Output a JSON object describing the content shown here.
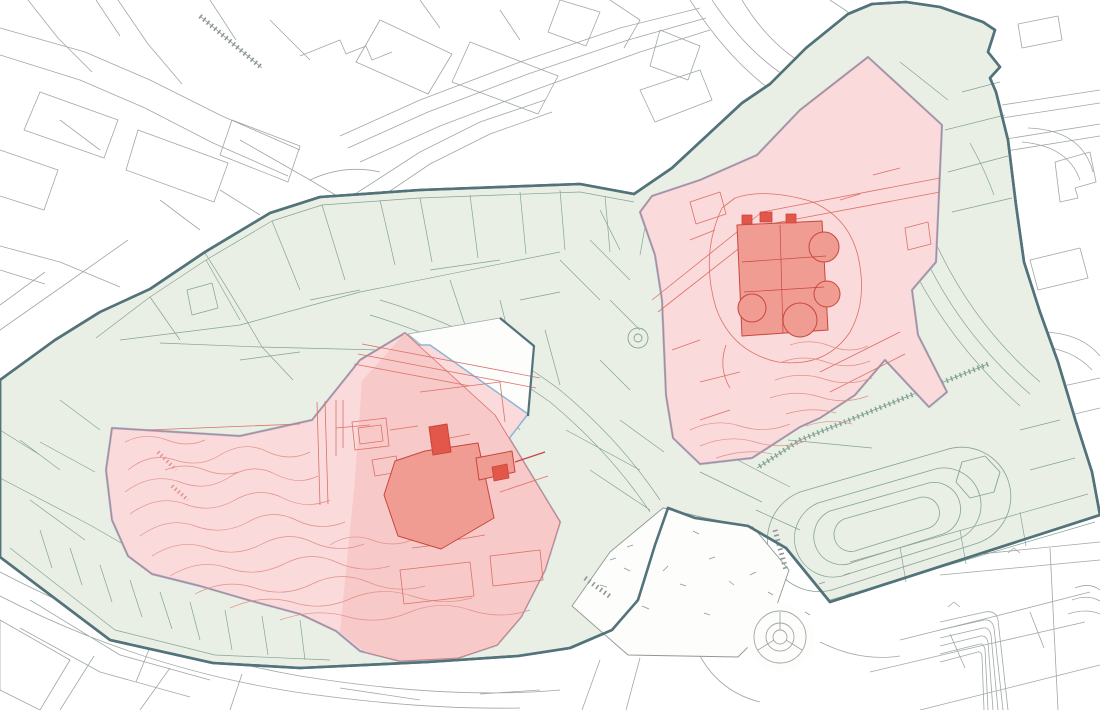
{
  "meta": {
    "title": "",
    "visible_text": []
  },
  "canvas": {
    "width": 1100,
    "height": 710
  },
  "palette": {
    "white": "#fdfdfc",
    "city_line": "#a0a7a7",
    "city_line_dark": "#8f9898",
    "green_fill": "#e9efe5",
    "green_line": "#85a396",
    "boundary": "#53737b",
    "blue_edge": "#8cb6d8",
    "pink_light": "#fadadb",
    "pink_deep": "#f7c9c8",
    "red_line": "#dd7068",
    "contour": "#e29189",
    "building_fill": "#f09c93",
    "building_dark": "#e2574a",
    "building_stroke": "#c8473c",
    "none": "none"
  },
  "layers": [
    {
      "name": "city-street-lines",
      "elements": [
        {
          "t": "path",
          "n": "city-streets-northwest",
          "s": "city_line",
          "w": 0.8,
          "d": "M0 28 L85 52 L150 80 L222 116 L300 150 M0 55 L80 80 L145 108 L213 143 L288 176 M28 0 L58 38 L92 72 M118 0 L148 44 L182 84 M0 150 L58 170 L44 210 L0 196 M40 92 L118 120 L104 158 L24 130 Z M138 130 L228 163 L214 202 L126 170 Z M232 120 L300 146 L288 182 L220 155 Z M0 246 L60 262 M0 270 L45 284 M60 262 L120 287 M0 330 L60 288 L128 240 M0 305 L45 272 M96 0 L120 36 M210 0 L236 40 M270 20 L310 60 M60 120 L100 150 M160 200 L200 230 M220 190 L260 215"
        },
        {
          "t": "path",
          "n": "city-streets-top-center",
          "s": "city_line",
          "w": 0.8,
          "d": "M340 136 L420 100 L520 62 L620 28 L700 8 M348 148 L428 112 L528 74 L628 40 L706 18 M360 162 L440 126 L540 88 L640 52 L710 30 M380 20 L452 54 L428 94 L356 62 Z M470 42 L558 76 L538 114 L452 82 Z M560 0 L600 12 L586 46 L548 32 Z M420 0 L440 28 M500 10 L520 40 M610 0 L640 20 L624 48 M660 30 L700 46 L688 80 L650 66 Z M640 90 L700 70 L712 100 L655 122 Z M300 56 L340 40 L346 54 L366 46 L372 60 L392 52 M240 140 L310 180 L344 200 M310 180 Q344 164 380 172 M330 206 L352 197 L348 215 Z M299 219 L321 211 L317 229 Z M352 196 L420 152 L480 122 L545 100 M362 210 L430 164 L490 134 L552 112"
        },
        {
          "t": "path",
          "n": "city-streets-northeast",
          "s": "city_line",
          "w": 0.8,
          "d": "M690 0 Q726 56 768 88 M712 0 Q744 48 782 74 M742 0 Q766 40 800 62 M1018 24 L1058 16 L1062 40 L1022 48 Z M1002 105 L1100 90 M1002 118 L1100 103 M1000 140 L1100 124 M1000 152 L1100 136 M1028 128 Q1082 130 1093 172 M1022 142 Q1068 146 1080 180 M1055 162 L1090 152 L1096 182 L1075 188 L1078 198 L1060 202 Z M830 0 L848 12 M960 250 L1010 238 L1018 268 L968 280 Z M1030 260 L1080 248 L1088 278 L1038 290 Z M975 302 L1030 290 L1038 320 L983 332 Z M1040 332 Q1080 332 1100 356 M1035 346 Q1072 348 1092 370 M1045 390 L1100 378 M1050 420 L1100 408"
        },
        {
          "t": "path",
          "n": "city-streets-south",
          "s": "city_line",
          "w": 0.8,
          "d": "M900 640 L1000 615 L1090 592 M870 672 L980 646 L1085 622 M920 710 L1020 685 L1100 665 M950 634 L965 668 M1030 612 L1044 648 M940 558 L1100 542 M940 575 L1100 560 M1050 548 L1058 710 M600 660 L582 710 M640 658 L626 710 M700 656 Q720 692 760 702 M820 642 Q860 662 900 656 M0 572 Q150 650 300 676 Q450 700 560 690 M0 596 Q140 668 295 692 Q420 710 520 708 M60 710 L94 656 M140 710 L170 668 M30 600 L120 655 L210 680 M20 628 L100 672 L190 697 M152 642 L136 682 M242 674 L230 710 M0 620 L70 660 L40 710 L0 690 Z M340 688 L420 700 M480 694 L540 690"
        },
        {
          "t": "path",
          "n": "terraced-building-lines",
          "s": "city_line",
          "w": 0.8,
          "d": "M940 622 L985 612 Q996 610 998 620 L1008 710 M940 630 L984 620 Q992 619 994 628 L1003 710 M940 638 L983 628 Q989 627 991 635 L998 710 M940 646 L981 636 Q986 635 988 642 L993 710 M940 654 L980 644 Q983 643 985 649 L988 710 M940 662 L978 652 Q981 651 982 656 L984 710 M1008 553 L1014 548 L1020 553 M948 607 L954 602 L960 607 M1075 588 Q1090 582 1100 590 M1072 600 Q1088 594 1100 601 M1068 614 Q1086 608 1100 614"
        },
        {
          "t": "path",
          "n": "railway-hatch-line",
          "s": "city_line_dark",
          "w": 5,
          "dash": "1.6 3.2",
          "d": "M200 16 L262 68"
        },
        {
          "t": "path",
          "n": "railway-line",
          "s": "city_line_dark",
          "w": 0.8,
          "d": "M200 16 L262 68"
        }
      ]
    },
    {
      "name": "protected-zone",
      "elements": [
        {
          "t": "polygon",
          "n": "protected-zone-area",
          "f": "green_fill",
          "s": "boundary",
          "w": 2.6,
          "pts": "0,380 55,340 100,312 150,289 205,252 270,213 320,197 420,190 580,184 634,194 672,168 742,103 770,84 806,48 848,14 872,4 906,2 940,7 983,22 995,30 988,52 1000,67 990,78 996,92 1008,140 1016,205 1024,262 1040,312 1058,362 1076,422 1092,472 1100,515 830,602 786,548 748,526 695,518 668,508 655,545 638,600 612,630 570,648 518,656 428,662 300,668 213,663 110,640 0,557"
        }
      ]
    },
    {
      "name": "cadastral-parcel-lines",
      "elements": [
        {
          "t": "path",
          "n": "parcel-lines-northwest",
          "s": "green_line",
          "w": 0.7,
          "d": "M96 338 L150 297 L206 260 L272 221 L322 205 L420 198 L580 192 L634 202 M150 297 L180 340 M206 260 L240 320 M272 221 L300 290 M322 205 L345 280 M380 200 L395 265 M420 198 L432 262 M470 195 L478 258 M520 192 L526 254 M560 190 L565 250 M605 196 L610 252 M120 340 L240 325 L360 292 L560 252 M205 253 Q235 300 262 347 L293 380 M160 343 L260 347 L380 350 M187 290 L212 283 L218 308 L192 315 Z M240 360 L300 352 M310 300 L360 290 M430 270 L500 260 M520 300 L560 292"
        },
        {
          "t": "path",
          "n": "parcel-lines-old-town",
          "s": "green_line",
          "w": 0.7,
          "d": "M380 300 Q480 330 560 390 Q620 440 660 500 M370 315 Q470 345 550 402 Q610 452 650 512 M450 280 L470 340 M500 300 L515 360 M545 330 L560 385 M480 380 L520 430 M430 360 L460 420 M400 380 L428 438 M560 260 L600 300 M590 240 L630 280 M610 300 L640 330 M600 360 L630 390 M566 430 L640 470 M590 470 L650 510 M620 420 L664 452 M648 210 L640 255 M600 210 L620 250"
        },
        {
          "t": "path",
          "n": "parcel-lines-east",
          "s": "green_line",
          "w": 0.7,
          "d": "M945 130 L1005 115 M948 172 L1008 156 M952 212 L1012 198 M962 92 L1000 82 M880 92 L930 130 M900 62 L948 100 M930 230 Q968 320 1040 382 M918 242 Q956 330 1030 394 M906 254 Q946 340 1020 406 M970 143 Q985 170 994 195 M1020 430 L1060 420 M1030 470 L1075 458"
        },
        {
          "t": "path",
          "n": "parcel-lines-south",
          "s": "green_line",
          "w": 0.7,
          "d": "M10 548 L115 630 L215 655 L330 660 M40 530 L52 568 M70 548 L82 585 M100 565 L112 602 M130 580 L142 617 M160 592 L172 629 M190 602 L200 640 M225 610 L232 650 M262 616 L268 655 M300 620 L305 660 M0 478 L90 525 L130 548 M20 440 L60 470 M60 400 L100 430 M40 442 L95 472 M30 500 L85 540 M0 430 L40 455 M830 600 L1095 522 M850 562 L1088 494 M900 547 L906 582 M960 530 L966 564 M1020 512 L1026 546 M700 472 L762 502 M722 452 L790 487 M756 510 L800 530"
        },
        {
          "t": "path",
          "n": "stadium-track",
          "s": "green_line",
          "w": 0.8,
          "d": "M800 492 L945 450 A48 48 0 0 1 978 543 L838 588 A48 48 0 0 1 800 492 Z M818 503 L932 470 A36 36 0 0 1 956 540 L848 574 A36 36 0 0 1 818 503 Z M830 511 L925 484 A26 26 0 0 1 943 534 L854 562 A26 26 0 0 1 830 511 Z M844 519 L918 498 A15 15 0 0 1 929 528 L858 550 A15 15 0 0 1 844 519 Z M788 440 L872 448"
        },
        {
          "t": "path",
          "n": "hexagon-building",
          "s": "green_line",
          "w": 0.9,
          "d": "M962 462 L985 456 L1000 472 L994 492 L970 498 L956 482 Z"
        },
        {
          "t": "circle",
          "n": "well-circle-outer",
          "s": "green_line",
          "w": 0.9,
          "cx": 638,
          "cy": 338,
          "r": 10
        },
        {
          "t": "circle",
          "n": "well-circle-inner",
          "s": "green_line",
          "w": 0.9,
          "cx": 638,
          "cy": 338,
          "r": 4
        },
        {
          "t": "path",
          "n": "retaining-wall-hatch",
          "s": "green_line",
          "w": 5,
          "dash": "1.6 3.2",
          "d": "M988 364 L800 440 L757 468"
        },
        {
          "t": "path",
          "n": "retaining-wall-line",
          "s": "green_line",
          "w": 0.8,
          "d": "M988 364 L800 440 L757 468"
        }
      ]
    },
    {
      "name": "street-wedge",
      "elements": [
        {
          "t": "polygon",
          "n": "access-road-wedge",
          "f": "white",
          "s": "city_line",
          "w": 0.8,
          "pts": "500,318 534,346 528,416 430,352 408,334"
        }
      ]
    },
    {
      "name": "monument-zone-castle-hill",
      "elements": [
        {
          "t": "polygon",
          "n": "castle-hill-zone-area",
          "f": "pink_light",
          "s": "blue_edge",
          "w": 2.2,
          "pts": "112,428 160,431 240,436 312,420 360,360 405,333 495,415 560,522 545,570 521,617 497,645 458,658 400,661 360,651 336,631 300,614 248,600 200,586 152,574 128,556 112,520 106,470"
        },
        {
          "t": "polygon",
          "n": "castle-hill-northeast-lobe",
          "f": "pink_light",
          "s": "blue_edge",
          "w": 1.5,
          "pts": "430,345 528,414 508,440 452,396 412,345"
        },
        {
          "t": "polygon",
          "n": "castle-esplanade-area",
          "f": "pink_deep",
          "pts": "405,333 495,415 560,522 545,570 521,617 497,645 458,658 400,661 365,652 340,632 355,480 362,381"
        },
        {
          "t": "polygon",
          "n": "castle-hill-red-boundary",
          "s": "red_line",
          "w": 0.8,
          "pts": "112,428 160,431 240,436 312,420 360,360 405,333 495,415 560,522 545,570 521,617 497,645 458,658 400,661 360,651 336,631 300,614 248,600 200,586 152,574 128,556 112,520 106,470"
        },
        {
          "t": "path",
          "n": "hill-contour-lines",
          "s": "contour",
          "w": 0.7,
          "d": "M125 442 Q145 432 167 440 Q187 448 205 440 M128 470 Q150 452 175 460 Q200 468 220 455 Q245 440 268 452 Q290 462 310 452 M125 492 Q152 472 180 482 Q205 492 228 478 Q252 462 275 474 Q298 486 318 476 M130 514 Q158 494 185 504 Q210 514 235 500 Q260 486 283 498 Q306 510 330 500 M140 536 Q168 516 195 526 Q222 536 248 522 Q272 508 296 520 Q320 532 345 522 M152 556 Q180 538 208 548 Q235 558 262 544 Q288 530 312 542 Q338 554 364 544 M170 576 Q200 558 228 568 Q256 578 284 564 Q310 550 336 562 Q362 574 390 566 M195 594 Q226 578 255 588 Q284 598 312 584 Q340 570 368 582 Q396 594 425 586 M230 608 Q262 594 292 602 Q322 612 352 598 Q382 586 412 596 Q442 606 472 598 M280 620 Q315 608 345 616 Q378 626 410 612 Q440 600 470 610 Q500 620 530 610 M165 470 Q185 462 205 470 Q225 478 245 470 M330 545 Q350 532 372 540 Q392 548 412 540"
        },
        {
          "t": "path",
          "n": "hill-stairs-hatch",
          "s": "contour",
          "w": 4,
          "dash": "1.4 2.8",
          "d": "M158 452 L176 470 M172 486 L188 500"
        },
        {
          "t": "path",
          "n": "former-buildings-red-lines",
          "s": "red_line",
          "w": 0.8,
          "d": "M317 402 L320 505 M325 401 L328 504 M352 422 L386 418 L389 446 L355 450 Z M358 428 L381 425 L383 441 L360 444 Z M362 344 L540 378 M358 354 L536 388 M354 364 L470 386 M420 392 L500 382 L505 422 M430 442 L470 434 M400 570 L470 562 L474 596 L404 604 Z M490 556 L540 550 L543 580 L493 586 Z M500 492 L548 476 M148 430 L300 424 M336 400 L336 456 M343 400 L343 448 M336 428 L370 425 M390 430 L418 426 M372 460 L396 456 L399 472 L375 476 Z M412 548 L444 544 M455 540 L485 535"
        },
        {
          "t": "polygon",
          "n": "palace-building",
          "f": "building_fill",
          "s": "building_stroke",
          "w": 1,
          "pts": "384,495 395,461 425,451 478,443 494,518 441,549 398,536"
        },
        {
          "t": "polygon",
          "n": "palace-tower",
          "f": "building_dark",
          "s": "building_stroke",
          "w": 1,
          "pts": "429,427 447,424 451,452 433,455"
        },
        {
          "t": "polygon",
          "n": "palace-east-wing",
          "f": "building_fill",
          "s": "building_stroke",
          "w": 1,
          "pts": "476,458 512,451 515,472 479,480"
        },
        {
          "t": "polygon",
          "n": "palace-east-annex",
          "f": "building_dark",
          "s": "building_stroke",
          "w": 0.8,
          "pts": "492,467 507,464 509,478 494,481"
        },
        {
          "t": "path",
          "n": "palace-wall-line",
          "s": "building_stroke",
          "w": 1.2,
          "d": "M515 462 L545 452"
        }
      ]
    },
    {
      "name": "monument-zone-old-quarter",
      "elements": [
        {
          "t": "polygon",
          "n": "old-quarter-zone-area",
          "f": "pink_light",
          "s": "blue_edge",
          "w": 2.2,
          "pts": "868,57 942,125 936,262 912,290 918,335 947,392 929,407 885,360 855,395 820,418 800,427 752,458 700,464 673,438 666,395 662,300 655,255 640,212 652,196 700,180 757,155 800,110"
        },
        {
          "t": "polygon",
          "n": "old-quarter-red-boundary",
          "s": "red_line",
          "w": 0.8,
          "pts": "868,57 942,125 936,262 912,290 918,335 947,392 929,407 885,360 855,395 820,418 800,427 752,458 700,464 673,438 666,395 662,300 655,255 640,212 652,196 700,180 757,155 800,110"
        },
        {
          "t": "path",
          "n": "old-quarter-red-lines",
          "s": "red_line",
          "w": 0.8,
          "d": "M652 300 L762 212 L940 178 M658 312 L770 224 L940 192 M905 228 L928 222 L931 244 L908 250 Z M873 175 L900 168 M690 240 L715 230 M672 350 L700 340 M700 382 L740 372 M820 372 L900 332 M830 392 L905 354 M690 202 L720 192 L726 214 L696 224 Z M726 345 Q718 368 730 388 M840 200 L860 194 M700 420 L730 410"
        },
        {
          "t": "path",
          "n": "castle-bailey-outline",
          "s": "red_line",
          "w": 0.8,
          "d": "M722 208 Q700 255 716 308 Q732 352 778 362 Q826 368 850 332 Q868 300 858 256 Q848 216 810 201 Q764 188 735 198 Z"
        },
        {
          "t": "path",
          "n": "slope-contour-lines",
          "s": "contour",
          "w": 0.7,
          "d": "M690 430 Q715 418 740 426 Q765 434 790 424 M700 446 Q728 434 755 442 Q780 450 806 441 M716 458 Q746 448 772 454 M790 345 Q810 338 830 346 Q850 354 868 346 M782 362 Q804 354 826 362 Q848 370 870 361 M775 380 Q800 371 824 379 Q848 387 872 378 M770 398 Q796 389 820 397 Q844 405 868 396 M786 414 Q812 406 836 413 M806 426 Q830 418 852 424"
        },
        {
          "t": "polygon",
          "n": "castle-building",
          "f": "building_fill",
          "s": "building_stroke",
          "w": 1,
          "pts": "737,225 822,221 828,330 742,336"
        },
        {
          "t": "circle",
          "n": "castle-bastion-northeast",
          "f": "building_fill",
          "s": "building_stroke",
          "w": 1,
          "cx": 824,
          "cy": 247,
          "r": 15
        },
        {
          "t": "circle",
          "n": "castle-bastion-east",
          "f": "building_fill",
          "s": "building_stroke",
          "w": 1,
          "cx": 827,
          "cy": 294,
          "r": 13
        },
        {
          "t": "circle",
          "n": "castle-bastion-south",
          "f": "building_fill",
          "s": "building_stroke",
          "w": 1,
          "cx": 800,
          "cy": 320,
          "r": 17
        },
        {
          "t": "circle",
          "n": "castle-bastion-southwest",
          "f": "building_fill",
          "s": "building_stroke",
          "w": 1,
          "cx": 752,
          "cy": 308,
          "r": 14
        },
        {
          "t": "path",
          "n": "castle-inner-lines",
          "s": "building_stroke",
          "w": 0.7,
          "d": "M742 262 L826 256 M744 292 L824 287 M780 225 L783 333"
        },
        {
          "t": "path",
          "n": "castle-battlements",
          "f": "building_dark",
          "s": "building_stroke",
          "w": 0.8,
          "d": "M742 215 h10 v9 h-10 Z M760 212 h12 v10 h-12 Z M786 214 h10 v9 h-10 Z"
        }
      ]
    },
    {
      "name": "park-and-roundabout",
      "elements": [
        {
          "t": "polygon",
          "n": "park-terrain-area",
          "f": "white",
          "s": "city_line_dark",
          "w": 0.9,
          "pts": "663,508 705,518 753,527 789,570 770,625 738,657 628,655 572,606 610,552"
        },
        {
          "t": "path",
          "n": "park-terrain-marks",
          "s": "city_line_dark",
          "w": 0.8,
          "d": "M610 560 l6 -2 m8 10 l6 3 m-30 14 l7 2 m20 -40 l6 -2 m30 26 l5 -5 m12 18 l6 2 m-44 20 l7 3 m60 -50 l6 -2 m14 24 l5 4 m-30 28 l6 2 m40 -40 l6 -3 m12 20 l5 3 m-80 -64 l6 3 m120 50 l6 -2 m-20 30 l5 3 m-60 14 l6 2 m90 -36 l6 -2 m-8 -18 l6 -2"
        },
        {
          "t": "path",
          "n": "park-stairs-hatch",
          "s": "city_line_dark",
          "w": 5,
          "dash": "1.6 3.2",
          "d": "M585 578 L612 598 M775 530 L786 570"
        },
        {
          "t": "circle",
          "n": "roundabout-clearing",
          "f": "white",
          "cx": 780,
          "cy": 637,
          "r": 34
        },
        {
          "t": "circle",
          "n": "roundabout-outer-ring",
          "s": "city_line",
          "w": 0.9,
          "cx": 780,
          "cy": 637,
          "r": 26
        },
        {
          "t": "circle",
          "n": "roundabout-middle-ring",
          "s": "city_line",
          "w": 0.9,
          "cx": 780,
          "cy": 637,
          "r": 14
        },
        {
          "t": "circle",
          "n": "roundabout-center-island",
          "s": "city_line",
          "w": 0.9,
          "cx": 780,
          "cy": 637,
          "r": 7
        },
        {
          "t": "path",
          "n": "roundabout-spokes",
          "s": "city_line",
          "w": 0.9,
          "d": "M780 630 L780 612 M786 640 L802 650 M774 640 L758 650"
        }
      ]
    },
    {
      "name": "zone-boundary-overlay",
      "elements": [
        {
          "t": "polygon",
          "n": "zone-boundary",
          "s": "boundary",
          "w": 2.6,
          "pts": "0,380 55,340 100,312 150,289 205,252 270,213 320,197 420,190 580,184 634,194 672,168 742,103 770,84 806,48 848,14 872,4 906,2 940,7 983,22 995,30 988,52 1000,67 990,78 996,92 1008,140 1016,205 1024,262 1040,312 1058,362 1076,422 1092,472 1100,515 830,602 786,548 748,526 695,518 668,508 655,545 638,600 612,630 570,648 518,656 428,662 300,668 213,663 110,640 0,557"
        },
        {
          "t": "path",
          "n": "zone-boundary-wedge-edge",
          "s": "boundary",
          "w": 2.2,
          "d": "M500 318 L534 346 L528 416"
        }
      ]
    }
  ]
}
